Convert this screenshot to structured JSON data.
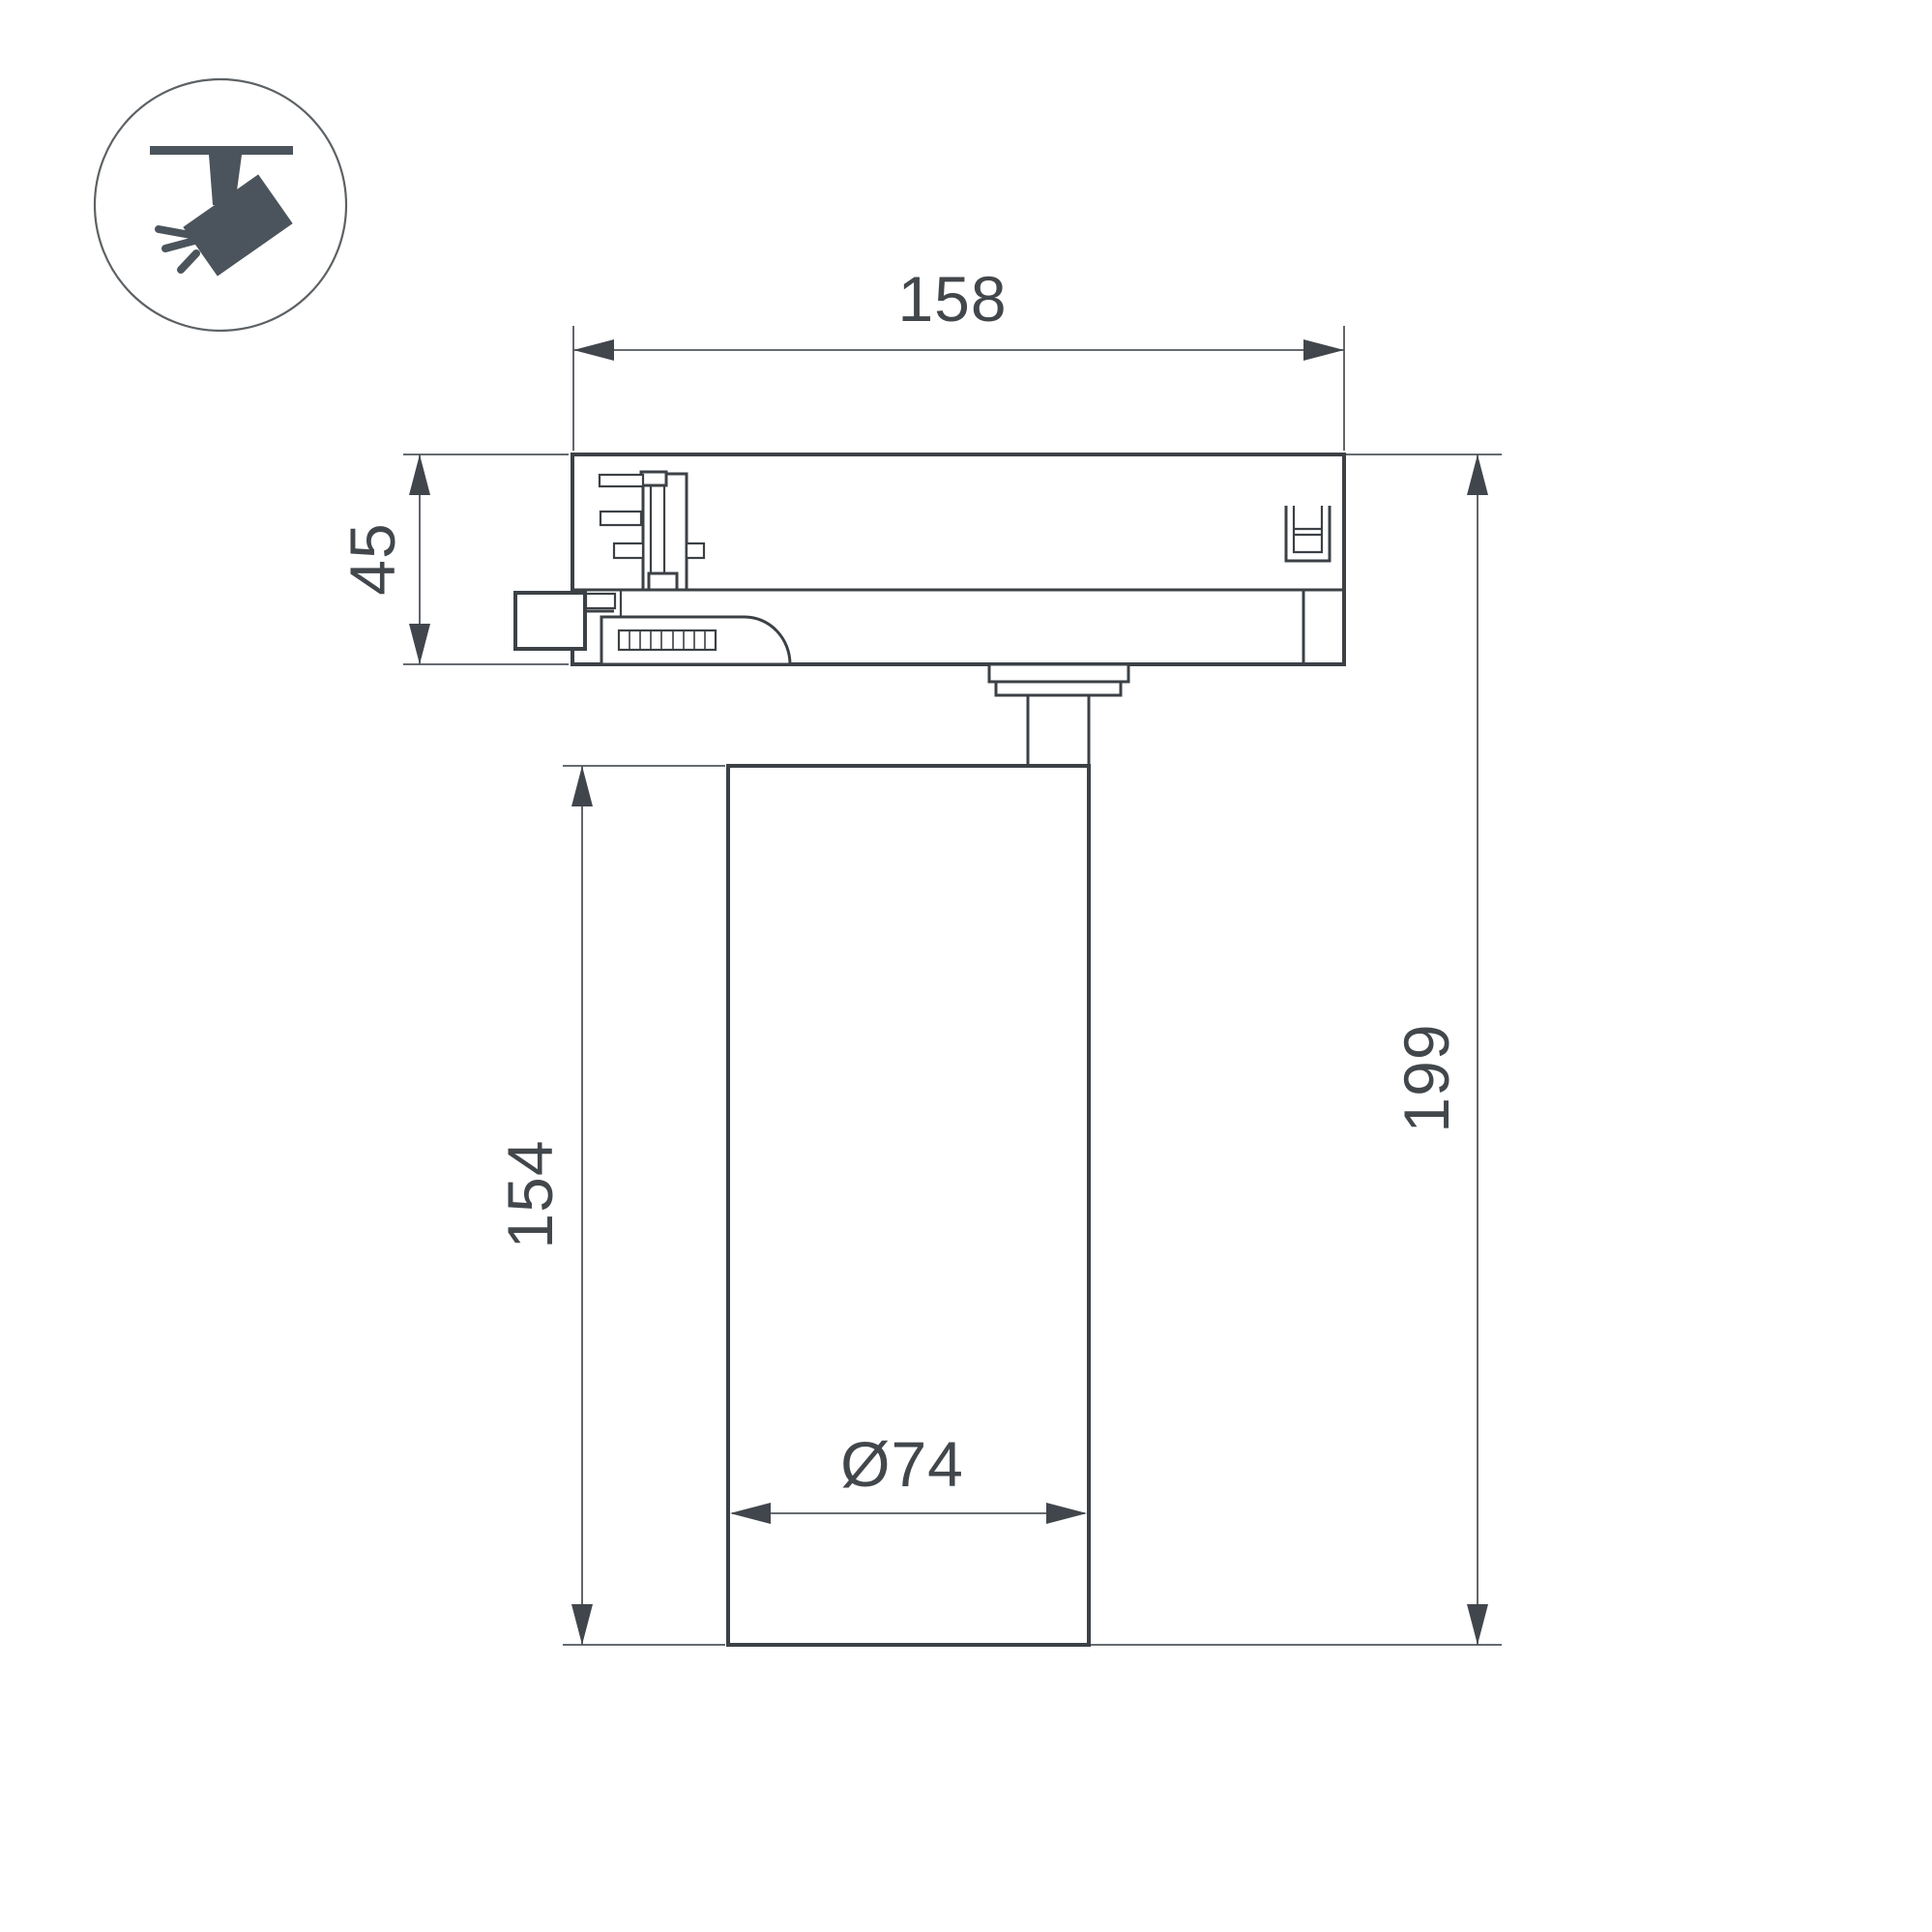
{
  "colors": {
    "background": "#ffffff",
    "outline": "#3c4146",
    "dimension_line": "#51565c",
    "arrow": "#41464c",
    "text": "#42474c",
    "icon": "#4b545c",
    "icon_circle": "#5c6165"
  },
  "icon": {
    "name": "track-spotlight-icon"
  },
  "dimensions": {
    "track_adapter_width": {
      "value": "158"
    },
    "track_adapter_height": {
      "value": "45"
    },
    "body_height": {
      "value": "154"
    },
    "total_height": {
      "value": "199"
    },
    "body_diameter": {
      "value": "Ø74"
    }
  }
}
